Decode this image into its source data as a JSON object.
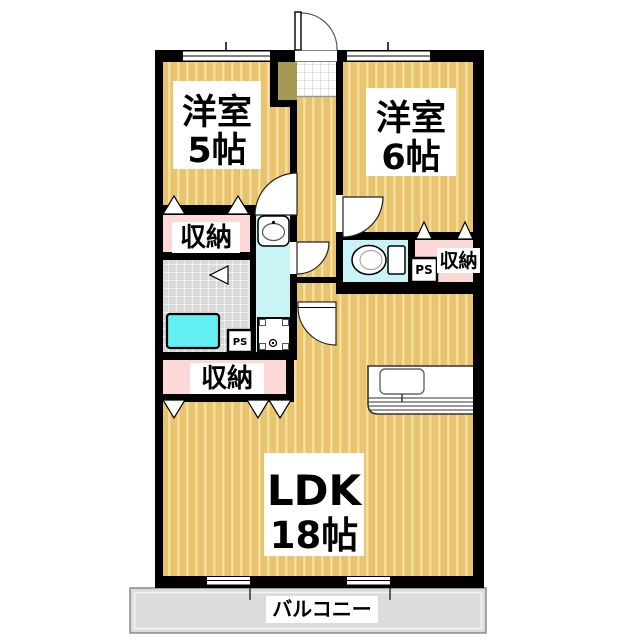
{
  "plan": {
    "bedroom_left": {
      "name": "洋室",
      "size": "5帖"
    },
    "bedroom_right": {
      "name": "洋室",
      "size": "6帖"
    },
    "ldk": {
      "name": "LDK",
      "size": "18帖"
    },
    "balcony": {
      "name": "バルコニー"
    },
    "closet_bedroom_left": {
      "name": "収納"
    },
    "closet_ldk": {
      "name": "収納"
    },
    "closet_bedroom_right": {
      "name": "収納"
    },
    "pipe_space_bath": {
      "name": "PS"
    },
    "pipe_space_toilet": {
      "name": "PS"
    }
  },
  "fixtures": [
    "entrance-door",
    "shoe-cabinet",
    "entry-tiles",
    "bathtub",
    "bath-tiles",
    "washbasin",
    "washing-machine-pan",
    "toilet",
    "kitchen-counter",
    "folding-closet-doors",
    "windows"
  ],
  "colors": {
    "floor": "#eac36e",
    "floor_stripe": "#f5e2a4",
    "closet": "#fcd8d6",
    "wet_room": "#c9f4f6",
    "bathtub": "#63eef2",
    "bath_tile": "#d9d9d9",
    "shoe_cabinet": "#a49a55",
    "balcony": "#dcdcdc",
    "wall": "#000000"
  }
}
